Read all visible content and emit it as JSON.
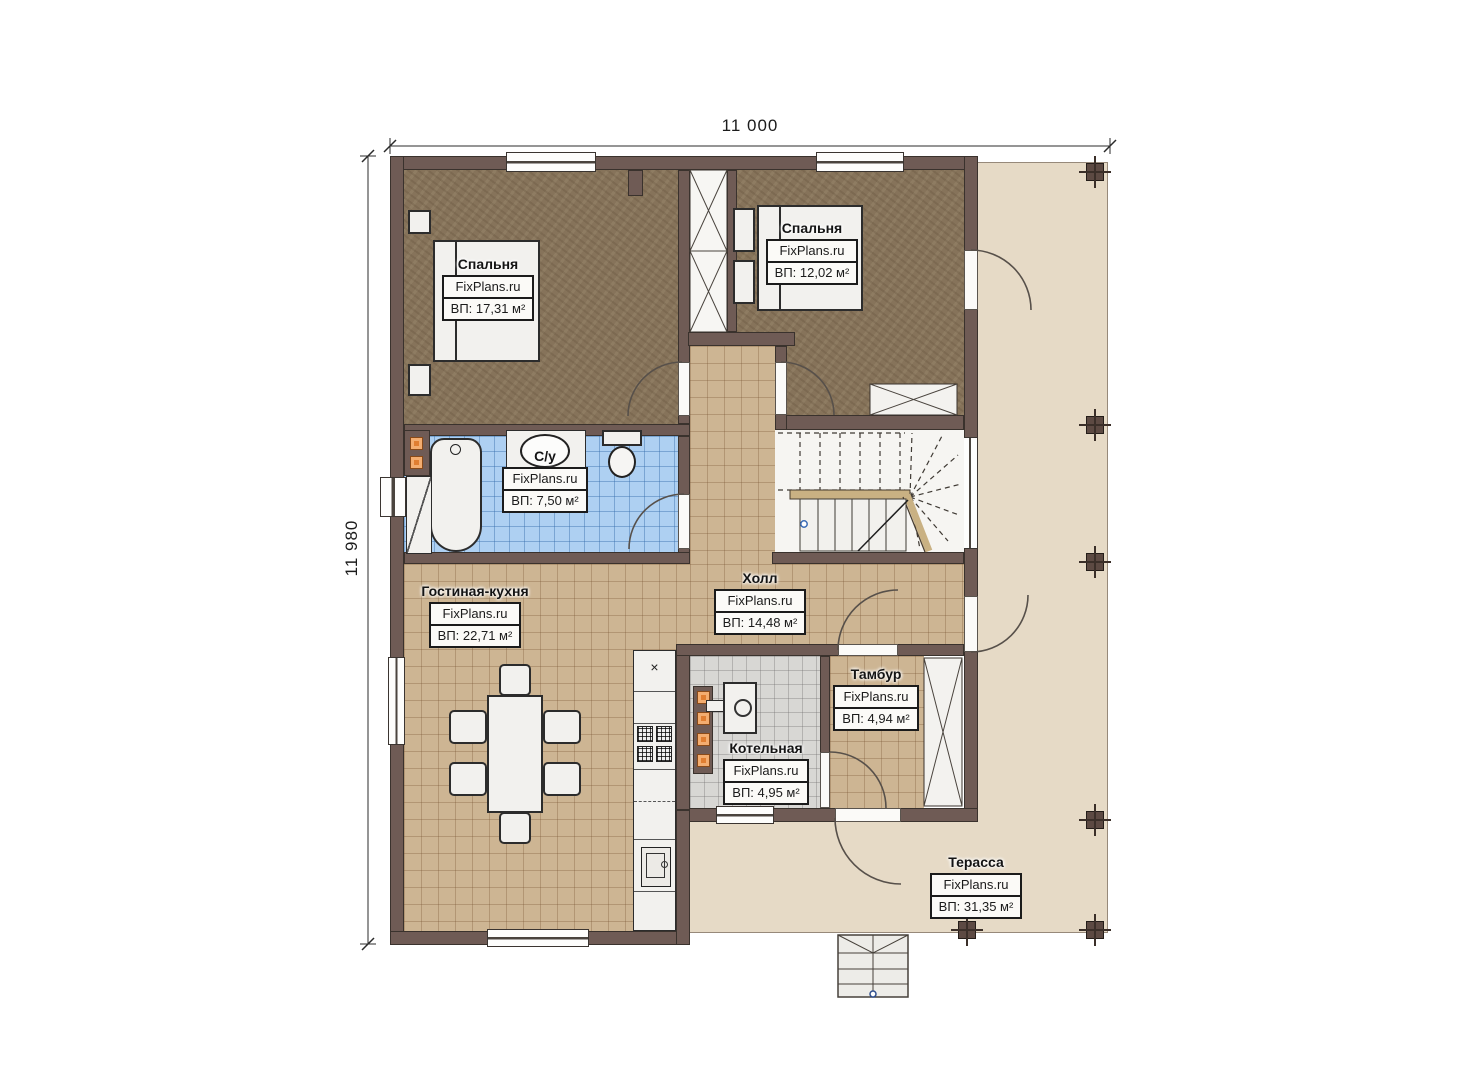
{
  "plan": {
    "brand": "FixPlans.ru",
    "dimensions": {
      "width_label": "11 000",
      "height_label": "11 980"
    },
    "rooms": [
      {
        "id": "bedroom-1",
        "name": "Спальня",
        "area": "ВП: 17,31 м²"
      },
      {
        "id": "bedroom-2",
        "name": "Спальня",
        "area": "ВП: 12,02 м²"
      },
      {
        "id": "bathroom",
        "name": "С/у",
        "area": "ВП: 7,50 м²"
      },
      {
        "id": "living-kitchen",
        "name": "Гостиная-кухня",
        "area": "ВП: 22,71 м²"
      },
      {
        "id": "hall",
        "name": "Холл",
        "area": "ВП: 14,48 м²"
      },
      {
        "id": "vestibule",
        "name": "Тамбур",
        "area": "ВП: 4,94 м²"
      },
      {
        "id": "boiler-room",
        "name": "Котельная",
        "area": "ВП: 4,95 м²"
      },
      {
        "id": "terrace",
        "name": "Терасса",
        "area": "ВП: 31,35 м²"
      }
    ],
    "icons": {
      "vent": "×"
    },
    "colors": {
      "wall": "#6f5b55",
      "bedroom_floor": "#86735a",
      "tile_beige": "#cdb593",
      "tile_blue": "#aed0f2",
      "tile_gray": "#d8d7d4",
      "terrace": "#e6dac6",
      "accent_orange": "#e07e31"
    }
  }
}
